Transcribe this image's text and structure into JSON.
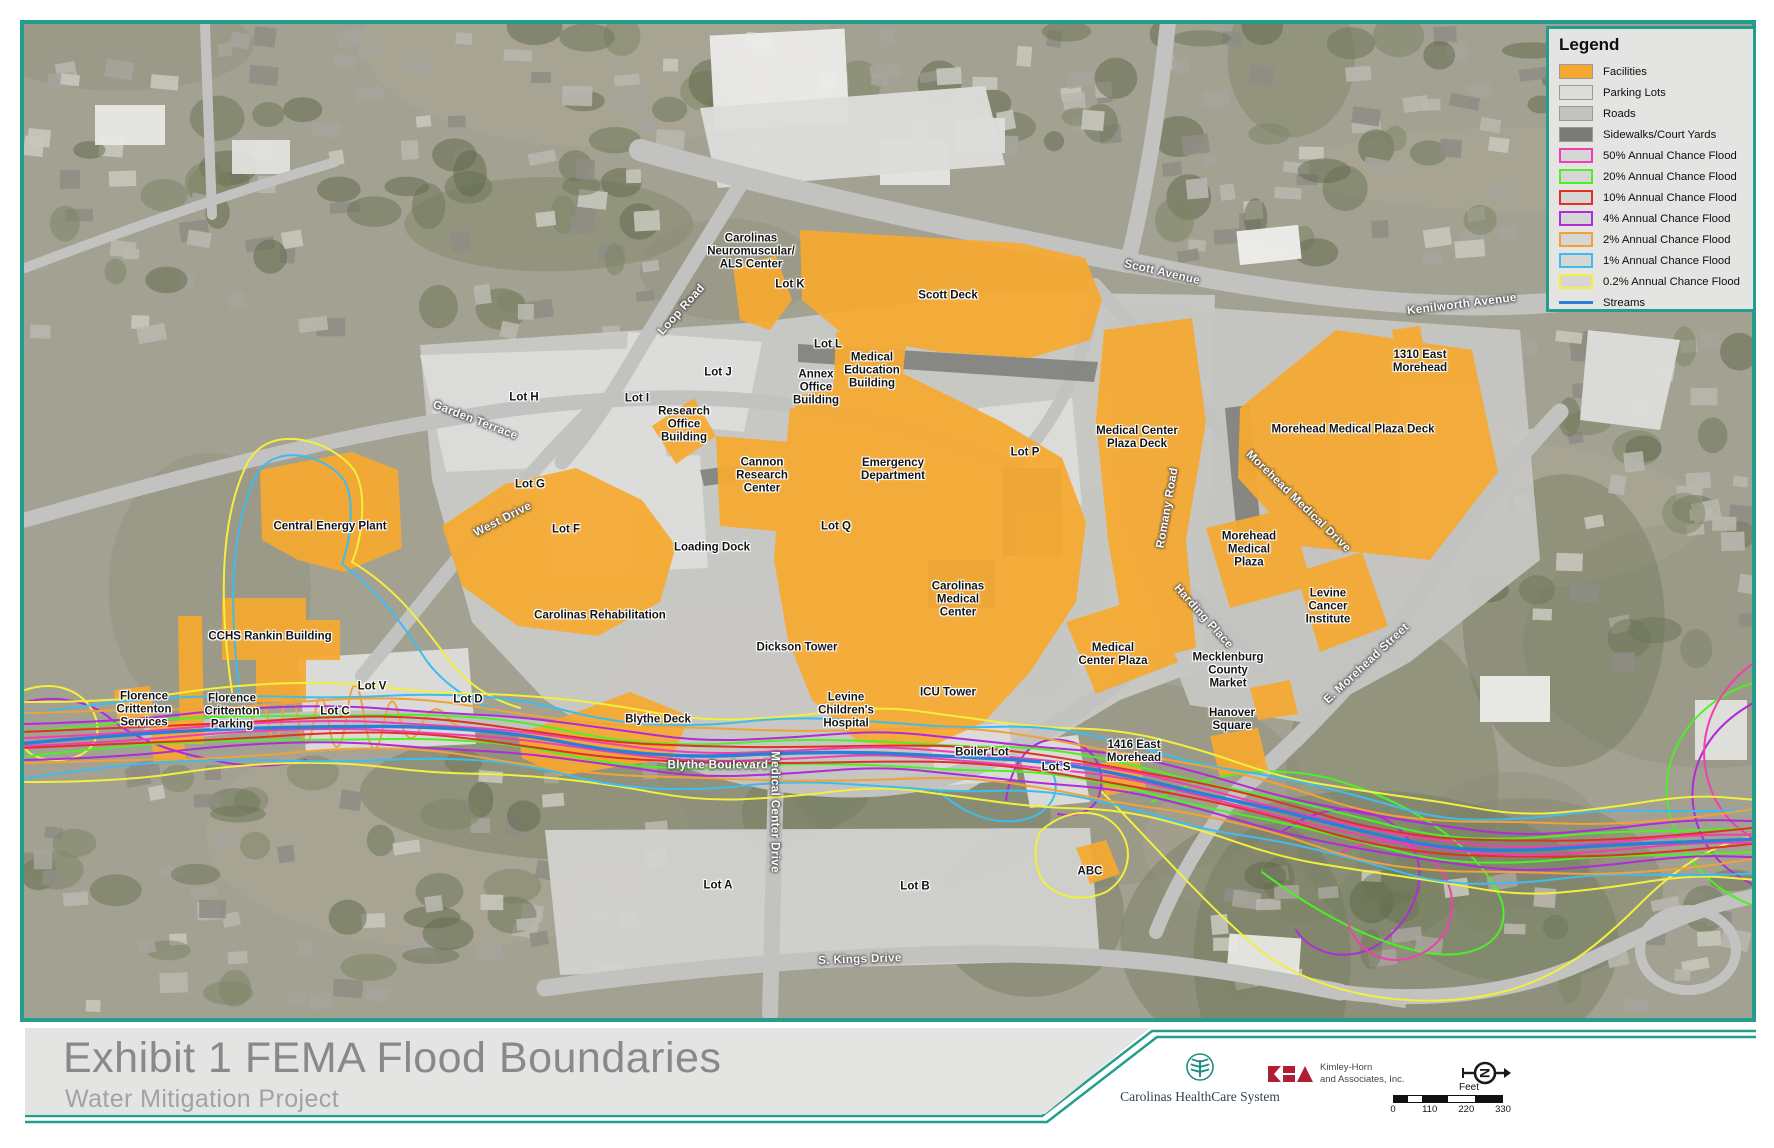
{
  "colors": {
    "accent": "#249E8C",
    "facility": "#F6A930",
    "parking": "#DCDCDA",
    "road": "#C2C2C0",
    "sidewalk": "#7B7B78",
    "flood50": "#F23EB1",
    "flood20": "#4DF026",
    "flood10": "#E03127",
    "flood4": "#B12BD8",
    "flood2": "#F0A238",
    "flood1": "#3FBCEE",
    "flood02": "#F2EF3D",
    "stream": "#2B7FD6"
  },
  "legend": {
    "title": "Legend",
    "items": [
      {
        "label": "Facilities",
        "swatch": "fill",
        "color": "facility"
      },
      {
        "label": "Parking Lots",
        "swatch": "fill",
        "color": "parking"
      },
      {
        "label": "Roads",
        "swatch": "fill",
        "color": "road"
      },
      {
        "label": "Sidewalks/Court Yards",
        "swatch": "fill",
        "color": "sidewalk"
      },
      {
        "label": "50% Annual Chance Flood",
        "swatch": "outline",
        "color": "flood50"
      },
      {
        "label": "20% Annual Chance Flood",
        "swatch": "outline",
        "color": "flood20"
      },
      {
        "label": "10% Annual Chance Flood",
        "swatch": "outline",
        "color": "flood10"
      },
      {
        "label": "4% Annual Chance Flood",
        "swatch": "outline",
        "color": "flood4"
      },
      {
        "label": "2% Annual Chance Flood",
        "swatch": "outline",
        "color": "flood2"
      },
      {
        "label": "1% Annual Chance Flood",
        "swatch": "outline",
        "color": "flood1"
      },
      {
        "label": "0.2% Annual Chance Flood",
        "swatch": "outline",
        "color": "flood02"
      },
      {
        "label": "Streams",
        "swatch": "line",
        "color": "stream"
      }
    ]
  },
  "map": {
    "labels": [
      {
        "text": "Carolinas\nNeuromuscular/\nALS Center",
        "x": 751,
        "y": 252,
        "rot": 0,
        "kind": "place"
      },
      {
        "text": "Lot K",
        "x": 790,
        "y": 285,
        "rot": 0,
        "kind": "place"
      },
      {
        "text": "Scott Deck",
        "x": 948,
        "y": 296,
        "rot": 0,
        "kind": "place"
      },
      {
        "text": "Lot L",
        "x": 828,
        "y": 345,
        "rot": 0,
        "kind": "place"
      },
      {
        "text": "Medical\nEducation\nBuilding",
        "x": 872,
        "y": 371,
        "rot": 0,
        "kind": "place"
      },
      {
        "text": "Annex\nOffice\nBuilding",
        "x": 816,
        "y": 388,
        "rot": 0,
        "kind": "place"
      },
      {
        "text": "Lot J",
        "x": 718,
        "y": 373,
        "rot": 0,
        "kind": "place"
      },
      {
        "text": "Lot I",
        "x": 637,
        "y": 399,
        "rot": 0,
        "kind": "place"
      },
      {
        "text": "Research\nOffice\nBuilding",
        "x": 684,
        "y": 425,
        "rot": 0,
        "kind": "place"
      },
      {
        "text": "Lot H",
        "x": 524,
        "y": 398,
        "rot": 0,
        "kind": "place"
      },
      {
        "text": "Lot G",
        "x": 530,
        "y": 485,
        "rot": 0,
        "kind": "place"
      },
      {
        "text": "Lot F",
        "x": 566,
        "y": 530,
        "rot": 0,
        "kind": "place"
      },
      {
        "text": "Central Energy Plant",
        "x": 330,
        "y": 527,
        "rot": 0,
        "kind": "place"
      },
      {
        "text": "Cannon\nResearch\nCenter",
        "x": 762,
        "y": 476,
        "rot": 0,
        "kind": "place"
      },
      {
        "text": "Emergency\nDepartment",
        "x": 893,
        "y": 470,
        "rot": 0,
        "kind": "place"
      },
      {
        "text": "Lot Q",
        "x": 836,
        "y": 527,
        "rot": 0,
        "kind": "place"
      },
      {
        "text": "Loading Dock",
        "x": 712,
        "y": 548,
        "rot": 0,
        "kind": "place"
      },
      {
        "text": "Medical Center\nPlaza Deck",
        "x": 1137,
        "y": 438,
        "rot": 0,
        "kind": "place"
      },
      {
        "text": "Lot P",
        "x": 1025,
        "y": 453,
        "rot": 0,
        "kind": "place"
      },
      {
        "text": "Morehead Medical Plaza Deck",
        "x": 1353,
        "y": 430,
        "rot": 0,
        "kind": "place"
      },
      {
        "text": "1310 East\nMorehead",
        "x": 1420,
        "y": 362,
        "rot": 0,
        "kind": "place"
      },
      {
        "text": "Morehead\nMedical\nPlaza",
        "x": 1249,
        "y": 550,
        "rot": 0,
        "kind": "place"
      },
      {
        "text": "Levine\nCancer\nInstitute",
        "x": 1328,
        "y": 607,
        "rot": 0,
        "kind": "place"
      },
      {
        "text": "Carolinas Rehabilitation",
        "x": 600,
        "y": 616,
        "rot": 0,
        "kind": "place"
      },
      {
        "text": "Carolinas\nMedical\nCenter",
        "x": 958,
        "y": 600,
        "rot": 0,
        "kind": "place"
      },
      {
        "text": "CCHS Rankin Building",
        "x": 270,
        "y": 637,
        "rot": 0,
        "kind": "place"
      },
      {
        "text": "Dickson Tower",
        "x": 797,
        "y": 648,
        "rot": 0,
        "kind": "place"
      },
      {
        "text": "Mecklenburg\nCounty\nMarket",
        "x": 1228,
        "y": 671,
        "rot": 0,
        "kind": "place"
      },
      {
        "text": "Florence\nCrittenton\nServices",
        "x": 144,
        "y": 710,
        "rot": 0,
        "kind": "place"
      },
      {
        "text": "Florence\nCrittenton\nParking",
        "x": 232,
        "y": 712,
        "rot": 0,
        "kind": "place"
      },
      {
        "text": "Lot V",
        "x": 372,
        "y": 687,
        "rot": 0,
        "kind": "place"
      },
      {
        "text": "Lot C",
        "x": 335,
        "y": 712,
        "rot": 0,
        "kind": "place"
      },
      {
        "text": "Lot D",
        "x": 468,
        "y": 700,
        "rot": 0,
        "kind": "place"
      },
      {
        "text": "Blythe Deck",
        "x": 658,
        "y": 720,
        "rot": 0,
        "kind": "place"
      },
      {
        "text": "Levine\nChildren's\nHospital",
        "x": 846,
        "y": 711,
        "rot": 0,
        "kind": "place"
      },
      {
        "text": "ICU Tower",
        "x": 948,
        "y": 693,
        "rot": 0,
        "kind": "place"
      },
      {
        "text": "Medical\nCenter Plaza",
        "x": 1113,
        "y": 655,
        "rot": 0,
        "kind": "place"
      },
      {
        "text": "1416 East\nMorehead",
        "x": 1134,
        "y": 752,
        "rot": 0,
        "kind": "place"
      },
      {
        "text": "Hanover\nSquare",
        "x": 1232,
        "y": 720,
        "rot": 0,
        "kind": "place"
      },
      {
        "text": "Boiler Lot",
        "x": 982,
        "y": 753,
        "rot": 0,
        "kind": "place"
      },
      {
        "text": "Lot S",
        "x": 1056,
        "y": 768,
        "rot": 0,
        "kind": "place"
      },
      {
        "text": "Lot A",
        "x": 718,
        "y": 886,
        "rot": 0,
        "kind": "place"
      },
      {
        "text": "Lot B",
        "x": 915,
        "y": 887,
        "rot": 0,
        "kind": "place"
      },
      {
        "text": "ABC",
        "x": 1090,
        "y": 872,
        "rot": 0,
        "kind": "place"
      },
      {
        "text": "Scott Avenue",
        "x": 1162,
        "y": 273,
        "rot": 13,
        "kind": "road"
      },
      {
        "text": "Kenilworth Avenue",
        "x": 1462,
        "y": 305,
        "rot": -7,
        "kind": "road"
      },
      {
        "text": "Loop Road",
        "x": 682,
        "y": 310,
        "rot": -48,
        "kind": "road"
      },
      {
        "text": "Garden Terrace",
        "x": 475,
        "y": 421,
        "rot": 21,
        "kind": "road"
      },
      {
        "text": "West Drive",
        "x": 503,
        "y": 520,
        "rot": -27,
        "kind": "road"
      },
      {
        "text": "Romany Road",
        "x": 1168,
        "y": 508,
        "rot": -80,
        "kind": "road"
      },
      {
        "text": "Morehead Medical Drive",
        "x": 1298,
        "y": 502,
        "rot": 44,
        "kind": "road"
      },
      {
        "text": "Harding Place",
        "x": 1203,
        "y": 617,
        "rot": 48,
        "kind": "road"
      },
      {
        "text": "E. Morehead Street",
        "x": 1367,
        "y": 664,
        "rot": -43,
        "kind": "road"
      },
      {
        "text": "Blythe Boulevard",
        "x": 718,
        "y": 766,
        "rot": 0,
        "kind": "road"
      },
      {
        "text": "Medical Center Drive",
        "x": 774,
        "y": 812,
        "rot": 90,
        "kind": "road"
      },
      {
        "text": "S. Kings Drive",
        "x": 860,
        "y": 960,
        "rot": -2,
        "kind": "road"
      }
    ]
  },
  "footer": {
    "title": "Exhibit 1 FEMA Flood Boundaries",
    "subtitle": "Water Mitigation Project",
    "org_healthcare": "Carolinas HealthCare System",
    "org_kh_line1": "Kimley-Horn",
    "org_kh_line2": "and Associates, Inc.",
    "scale_label": "Feet",
    "scale_ticks": [
      "0",
      "110",
      "220",
      "330"
    ]
  }
}
